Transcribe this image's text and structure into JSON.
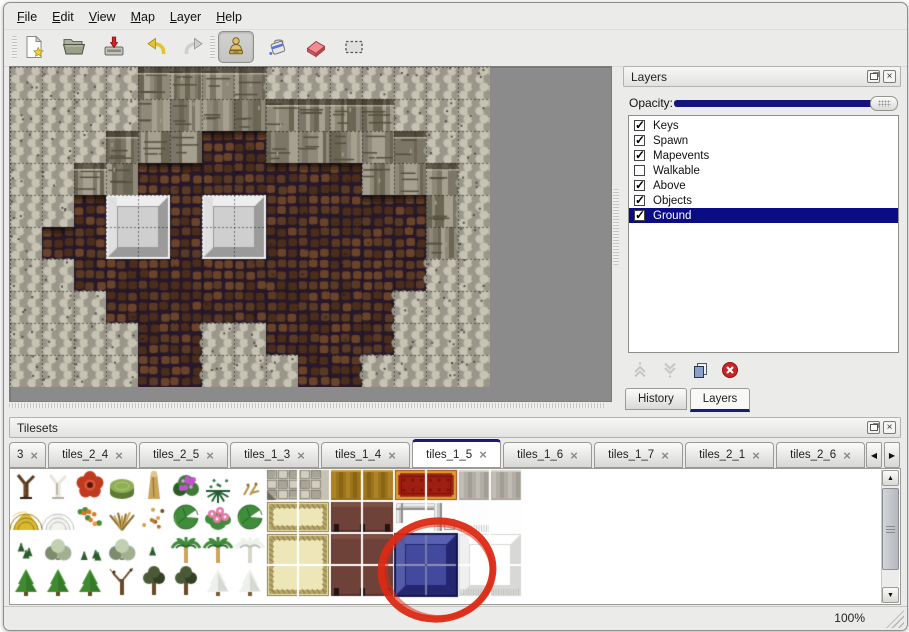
{
  "menu": {
    "items": [
      "File",
      "Edit",
      "View",
      "Map",
      "Layer",
      "Help"
    ]
  },
  "toolbar": {
    "buttons": [
      {
        "name": "new"
      },
      {
        "name": "open"
      },
      {
        "name": "save"
      },
      {
        "name": "undo"
      },
      {
        "name": "redo"
      },
      {
        "name": "stamp",
        "active": true
      },
      {
        "name": "fill"
      },
      {
        "name": "eraser"
      },
      {
        "name": "select"
      }
    ]
  },
  "icons": {
    "close": "×",
    "tab_close": "×",
    "check": "✓",
    "scroll_left": "◀",
    "scroll_right": "▶",
    "scroll_up": "▲",
    "scroll_down": "▼"
  },
  "map_view": {
    "tile_size": 32,
    "legend": {
      "S": "rough-stone",
      "C": "cliff-face",
      "F": "cobble-floor",
      "P": "platform"
    },
    "grid": [
      "SSSSCCCCSSSSSSS",
      "SSSSCCCCCCCCSSS",
      "SSSCCCFFCCCCCSS",
      "SSCCFFFFFFFCCCS",
      "SSFPPFPPFFFFFCS",
      "SFFPPFPPFFFFFCS",
      "SSFFFFFFFFFFFSS",
      "SSSFFFFFFFFFSSS",
      "SSSSFFSSFFFFSSS",
      "SSSSFFSSSFFSSSS"
    ],
    "platforms": [
      [
        3,
        4
      ],
      [
        6,
        4
      ]
    ],
    "palette": {
      "S": [
        "#b3af9f",
        "#c7c3b3",
        "#9a968a",
        "#6e6a5e",
        "#55514a"
      ],
      "C": [
        "#8e8978",
        "#a5a090",
        "#7c7668",
        "#6b6554",
        "#55503f"
      ],
      "F": [
        "#3f2718",
        "#5a3a24",
        "#4b2d1b",
        "#6b4329",
        "#27192a"
      ],
      "P": [
        "#c9c9c9",
        "#eeeeee",
        "#9a9a9a",
        "#cfcfcf",
        "#f2f2f0"
      ]
    }
  },
  "layers_panel": {
    "title": "Layers",
    "opacity_label": "Opacity:",
    "opacity_percent": 100,
    "selection_color": "#0b0b85",
    "layers": [
      {
        "name": "Keys",
        "checked": true,
        "selected": false
      },
      {
        "name": "Spawn",
        "checked": true,
        "selected": false
      },
      {
        "name": "Mapevents",
        "checked": true,
        "selected": false
      },
      {
        "name": "Walkable",
        "checked": false,
        "selected": false
      },
      {
        "name": "Above",
        "checked": true,
        "selected": false
      },
      {
        "name": "Objects",
        "checked": true,
        "selected": false
      },
      {
        "name": "Ground",
        "checked": true,
        "selected": true
      }
    ],
    "tabs": [
      {
        "label": "History",
        "active": false
      },
      {
        "label": "Layers",
        "active": true
      }
    ]
  },
  "tilesets_panel": {
    "title": "Tilesets",
    "tabs": [
      {
        "label": "3",
        "active": false
      },
      {
        "label": "tiles_2_4",
        "active": false
      },
      {
        "label": "tiles_2_5",
        "active": false
      },
      {
        "label": "tiles_1_3",
        "active": false
      },
      {
        "label": "tiles_1_4",
        "active": false
      },
      {
        "label": "tiles_1_5",
        "active": true
      },
      {
        "label": "tiles_1_6",
        "active": false
      },
      {
        "label": "tiles_1_7",
        "active": false
      },
      {
        "label": "tiles_2_1",
        "active": false
      },
      {
        "label": "tiles_2_6",
        "active": false
      }
    ],
    "tile_size": 32,
    "cells": [
      {
        "x": 0,
        "y": 0,
        "w": 1,
        "h": 1,
        "kind": "tree-trunk"
      },
      {
        "x": 1,
        "y": 0,
        "w": 1,
        "h": 1,
        "kind": "white-tree"
      },
      {
        "x": 2,
        "y": 0,
        "w": 1,
        "h": 1,
        "kind": "red-flower"
      },
      {
        "x": 3,
        "y": 0,
        "w": 1,
        "h": 1,
        "kind": "green-stump"
      },
      {
        "x": 4,
        "y": 0,
        "w": 1,
        "h": 1,
        "kind": "tan-trunk"
      },
      {
        "x": 5,
        "y": 0,
        "w": 1,
        "h": 1,
        "kind": "purple-flower-bush"
      },
      {
        "x": 6,
        "y": 0,
        "w": 1,
        "h": 1,
        "kind": "fern"
      },
      {
        "x": 7,
        "y": 0,
        "w": 1,
        "h": 1,
        "kind": "dry-twig"
      },
      {
        "x": 8,
        "y": 0,
        "w": 2,
        "h": 1,
        "kind": "stone-floor"
      },
      {
        "x": 10,
        "y": 0,
        "w": 2,
        "h": 1,
        "kind": "gold-floor"
      },
      {
        "x": 12,
        "y": 0,
        "w": 2,
        "h": 1,
        "kind": "red-carpet"
      },
      {
        "x": 14,
        "y": 0,
        "w": 2,
        "h": 1,
        "kind": "gray-floor"
      },
      {
        "x": 0,
        "y": 1,
        "w": 1,
        "h": 1,
        "kind": "hay-mound"
      },
      {
        "x": 1,
        "y": 1,
        "w": 1,
        "h": 1,
        "kind": "snow-mound"
      },
      {
        "x": 2,
        "y": 1,
        "w": 1,
        "h": 1,
        "kind": "orange-flowers"
      },
      {
        "x": 3,
        "y": 1,
        "w": 1,
        "h": 1,
        "kind": "grass-tuft"
      },
      {
        "x": 4,
        "y": 1,
        "w": 1,
        "h": 1,
        "kind": "fallen-leaves"
      },
      {
        "x": 5,
        "y": 1,
        "w": 1,
        "h": 1,
        "kind": "lily-pad"
      },
      {
        "x": 6,
        "y": 1,
        "w": 1,
        "h": 1,
        "kind": "pink-flowers"
      },
      {
        "x": 7,
        "y": 1,
        "w": 1,
        "h": 1,
        "kind": "lily-pad"
      },
      {
        "x": 8,
        "y": 1,
        "w": 2,
        "h": 1,
        "kind": "khaki-mat"
      },
      {
        "x": 10,
        "y": 1,
        "w": 2,
        "h": 1,
        "kind": "maroon-table"
      },
      {
        "x": 12,
        "y": 1,
        "w": 2,
        "h": 1,
        "kind": "silver-block"
      },
      {
        "x": 14,
        "y": 1,
        "w": 1,
        "h": 1,
        "kind": "white-fringe"
      },
      {
        "x": 15,
        "y": 1,
        "w": 1,
        "h": 1,
        "kind": "white-tile"
      },
      {
        "x": 0,
        "y": 2,
        "w": 1,
        "h": 1,
        "kind": "sprigs"
      },
      {
        "x": 1,
        "y": 2,
        "w": 1,
        "h": 1,
        "kind": "gray-bush"
      },
      {
        "x": 2,
        "y": 2,
        "w": 1,
        "h": 1,
        "kind": "sprigs"
      },
      {
        "x": 3,
        "y": 2,
        "w": 1,
        "h": 1,
        "kind": "gray-bush"
      },
      {
        "x": 4,
        "y": 2,
        "w": 1,
        "h": 1,
        "kind": "sprig"
      },
      {
        "x": 5,
        "y": 2,
        "w": 1,
        "h": 1,
        "kind": "palm-tree"
      },
      {
        "x": 6,
        "y": 2,
        "w": 1,
        "h": 1,
        "kind": "palm-tree"
      },
      {
        "x": 7,
        "y": 2,
        "w": 1,
        "h": 1,
        "kind": "snowy-palm"
      },
      {
        "x": 8,
        "y": 2,
        "w": 2,
        "h": 2,
        "kind": "khaki-mat"
      },
      {
        "x": 10,
        "y": 2,
        "w": 2,
        "h": 2,
        "kind": "maroon-table"
      },
      {
        "x": 12,
        "y": 2,
        "w": 2,
        "h": 2,
        "kind": "blue-block",
        "selected": true
      },
      {
        "x": 14,
        "y": 2,
        "w": 2,
        "h": 2,
        "kind": "white-block"
      },
      {
        "x": 0,
        "y": 3,
        "w": 1,
        "h": 1,
        "kind": "conifer"
      },
      {
        "x": 1,
        "y": 3,
        "w": 1,
        "h": 1,
        "kind": "conifer"
      },
      {
        "x": 2,
        "y": 3,
        "w": 1,
        "h": 1,
        "kind": "conifer"
      },
      {
        "x": 3,
        "y": 3,
        "w": 1,
        "h": 1,
        "kind": "bare-tree"
      },
      {
        "x": 4,
        "y": 3,
        "w": 1,
        "h": 1,
        "kind": "dark-tree"
      },
      {
        "x": 5,
        "y": 3,
        "w": 1,
        "h": 1,
        "kind": "dark-tree"
      },
      {
        "x": 6,
        "y": 3,
        "w": 1,
        "h": 1,
        "kind": "snowy-conifer"
      },
      {
        "x": 7,
        "y": 3,
        "w": 1,
        "h": 1,
        "kind": "snowy-conifer"
      }
    ],
    "palette": {
      "tree-trunk": [
        "#5a3b20",
        "#33200e",
        "#7a5a38"
      ],
      "white-tree": [
        "#e9e5da",
        "#b2aea2",
        "#8e8a7e"
      ],
      "red-flower": [
        "#c23a1e",
        "#5a1408",
        "#d85a3a"
      ],
      "green-stump": [
        "#8fae56",
        "#5c7a34",
        "#b2cc7c"
      ],
      "tan-trunk": [
        "#c9a45c",
        "#8a6a34",
        "#e2c78a"
      ],
      "purple-flower-bush": [
        "#3f7c36",
        "#2c5c26",
        "#c054cc",
        "#e892ea"
      ],
      "fern": [
        "#1f5c30",
        "#2f7a44"
      ],
      "dry-twig": [
        "#b89048",
        "#8a6828"
      ],
      "hay-mound": [
        "#d9b832",
        "#9c7c14",
        "#eed468"
      ],
      "snow-mound": [
        "#f2f2ee",
        "#c2c2bb",
        "#ffffff"
      ],
      "orange-flowers": [
        "#4a8a3a",
        "#e07820",
        "#f0a040"
      ],
      "grass-tuft": [
        "#c8a858",
        "#8a6a2a"
      ],
      "fallen-leaves": [
        "#b07830",
        "#d0a050",
        "#7a4a18"
      ],
      "lily-pad": [
        "#3f8c3a",
        "#2a6428",
        "#63ae58"
      ],
      "pink-flowers": [
        "#3f8c3a",
        "#e878a8",
        "#ffffff"
      ],
      "sprigs": [
        "#2a5c2c",
        "#447a44"
      ],
      "gray-bush": [
        "#a2b092",
        "#7e8c6e",
        "#c2d0b2"
      ],
      "sprig": [
        "#2a5c2c",
        "#447a44"
      ],
      "palm-tree": [
        "#3f8c3a",
        "#2a6428",
        "#c9a45c"
      ],
      "snowy-palm": [
        "#eef0ea",
        "#b8bcb2",
        "#d8d4c8"
      ],
      "conifer": [
        "#3f8c2e",
        "#2a6420",
        "#6a4a20"
      ],
      "bare-tree": [
        "#6a4a28",
        "#3a2810",
        "#8a6a44"
      ],
      "dark-tree": [
        "#4a5a36",
        "#333f22",
        "#6a4a28"
      ],
      "snowy-conifer": [
        "#eef0ec",
        "#b8bcb4",
        "#7a5a30"
      ],
      "stone-floor": [
        "#c5c1b3",
        "#d2cec0",
        "#a8a496",
        "#6e6a60"
      ],
      "gold-floor": [
        "#9c741c",
        "#b08426",
        "#8a6414",
        "#c89c3c"
      ],
      "red-carpet": [
        "#9e1e12",
        "#d9a22c",
        "#7a120a"
      ],
      "gray-floor": [
        "#b2aea6",
        "#c2beb6",
        "#a29e96",
        "#d5d1c9"
      ],
      "khaki-mat": [
        "#e4dead",
        "#b5a468",
        "#8a7a40",
        "#ece6b8"
      ],
      "maroon-table": [
        "#6e4238",
        "#7e5044",
        "#241310",
        "#55302a"
      ],
      "silver-block": [
        "#c8c8c8",
        "#ededed",
        "#8e8e8e",
        "#ffffff"
      ],
      "white-fringe": [
        "#fdfdfd",
        "#c8c8c4"
      ],
      "white-tile": [
        "#fefefe",
        "#e4e4e0"
      ],
      "blue-block": [
        "#434a9e",
        "#5a61b2",
        "#24276f",
        "#14164e"
      ],
      "white-block": [
        "#fbfbfa",
        "#ffffff",
        "#d8d8d4",
        "#c0c0bc"
      ]
    },
    "annotation": {
      "type": "ellipse",
      "color": "#dc2a14"
    }
  },
  "status_bar": {
    "zoom_level": "100%"
  },
  "colors": {
    "accent_navy": "#14147c",
    "window_bg": "#ebebe9",
    "selection_navy": "#0b0b85"
  }
}
